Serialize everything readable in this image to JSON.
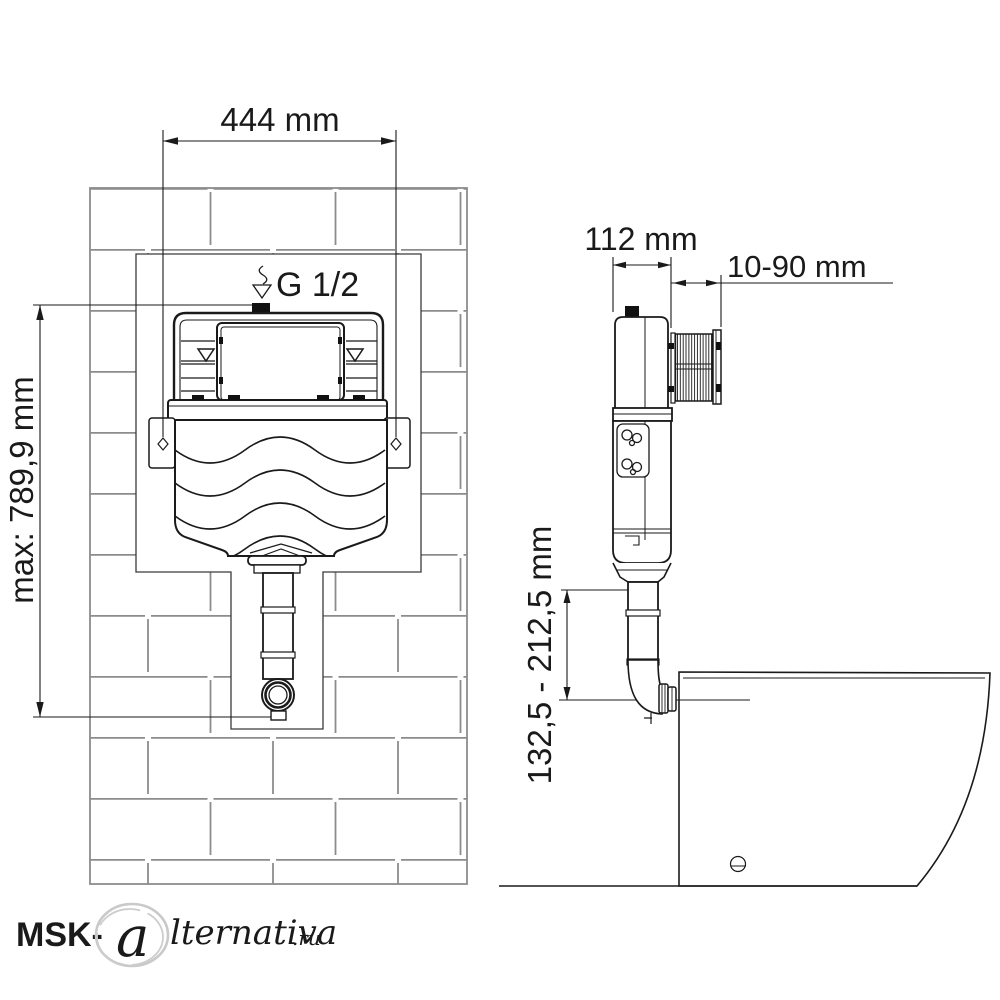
{
  "front_view": {
    "width_dim": "444 mm",
    "height_dim": "max: 789,9 mm",
    "inlet_label": "G 1/2"
  },
  "side_view": {
    "depth_dim": "112 mm",
    "wall_distance_dim": "10-90 mm",
    "outlet_height_dim": "132,5 - 212,5 mm"
  },
  "watermark": {
    "prefix": "MSK-",
    "stamp_letter": "a",
    "script": "lternativa",
    "suffix": ".ru"
  },
  "colors": {
    "line": "#1a1a1a",
    "brick": "#8c8c8c",
    "watermark": "#c6c6c6"
  }
}
